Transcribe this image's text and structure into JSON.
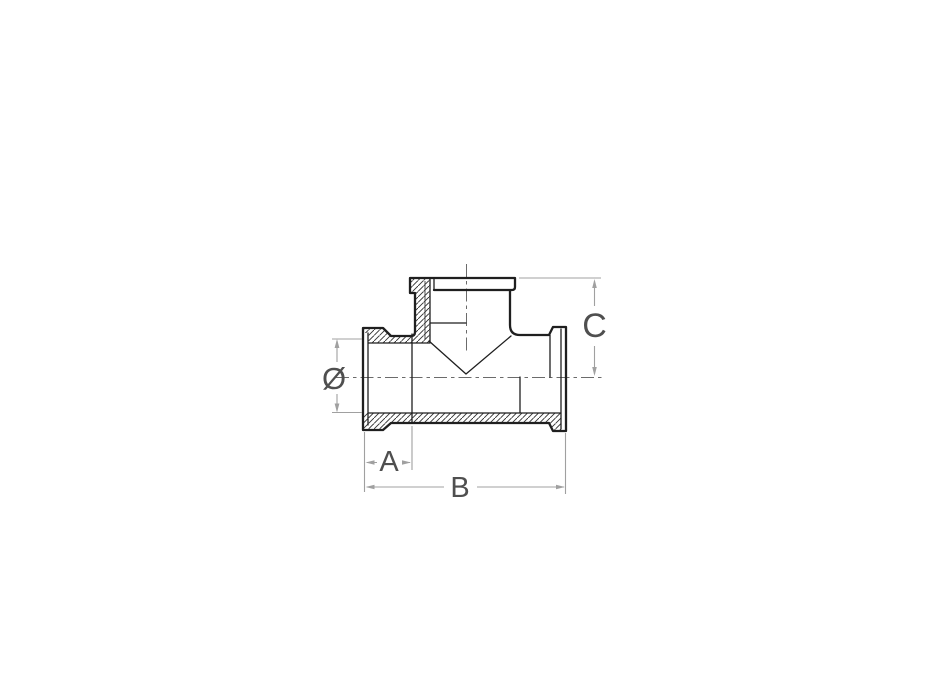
{
  "drawing": {
    "labels": {
      "diameter": "Ø",
      "dim_a": "A",
      "dim_b": "B",
      "dim_c": "C"
    },
    "colors": {
      "outline": "#1f1f1f",
      "dimension_line": "#a0a0a0",
      "dimension_text": "#4f4f4f",
      "centerline": "#6b6b6b",
      "background": "#ffffff"
    }
  }
}
